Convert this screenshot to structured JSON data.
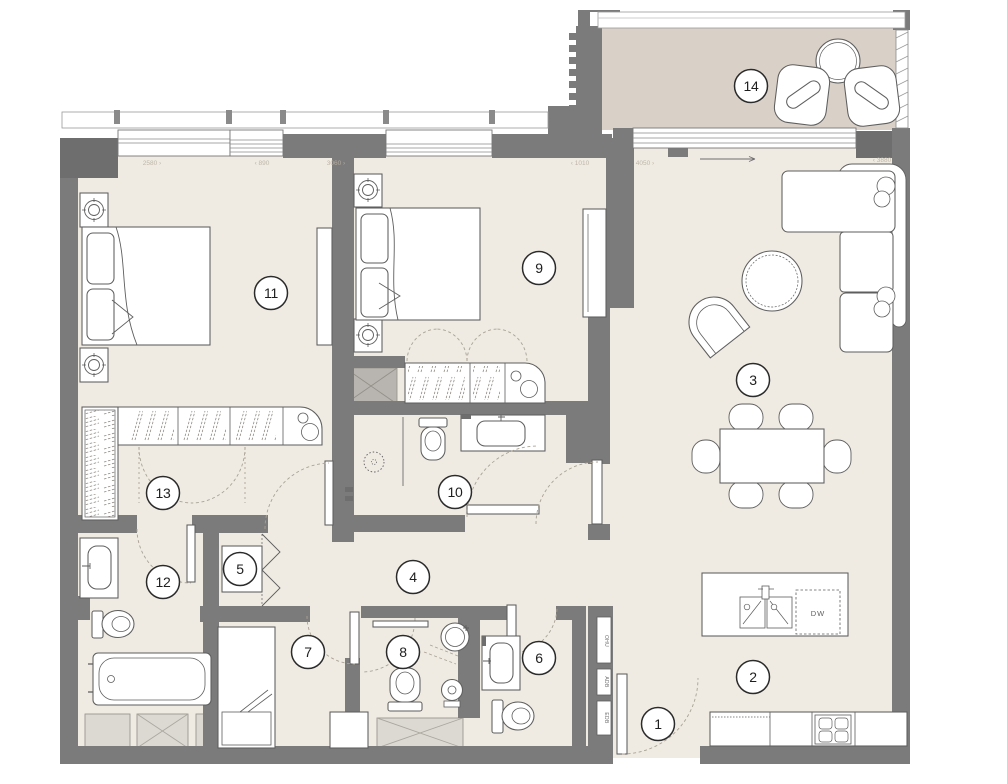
{
  "plan_title": "Apartment floor plan",
  "colors": {
    "wall": "#7b7b7b",
    "wall_dark": "#6e6e6e",
    "floor": "#efebe3",
    "balcony_floor": "#d9d0c8",
    "furniture_line": "#5e5e5e",
    "dash_line": "#a9a295",
    "shaft_fill": "#dcd9d3",
    "duct_fill": "#b8b5b0",
    "dim_text": "#b9b0a2"
  },
  "rooms": [
    {
      "label": "1",
      "x": 658,
      "y": 724
    },
    {
      "label": "2",
      "x": 753,
      "y": 677
    },
    {
      "label": "3",
      "x": 753,
      "y": 380
    },
    {
      "label": "4",
      "x": 413,
      "y": 577
    },
    {
      "label": "5",
      "x": 240,
      "y": 569
    },
    {
      "label": "6",
      "x": 539,
      "y": 658
    },
    {
      "label": "7",
      "x": 308,
      "y": 652
    },
    {
      "label": "8",
      "x": 403,
      "y": 652
    },
    {
      "label": "9",
      "x": 539,
      "y": 268
    },
    {
      "label": "10",
      "x": 455,
      "y": 492
    },
    {
      "label": "11",
      "x": 271,
      "y": 293
    },
    {
      "label": "12",
      "x": 163,
      "y": 582
    },
    {
      "label": "13",
      "x": 163,
      "y": 493
    },
    {
      "label": "14",
      "x": 751,
      "y": 86
    }
  ],
  "dimension_labels": [
    {
      "text": "2580 ›",
      "x": 152,
      "y": 165
    },
    {
      "text": "‹ 890",
      "x": 262,
      "y": 165
    },
    {
      "text": "3060 ›",
      "x": 336,
      "y": 165
    },
    {
      "text": "‹ 1010",
      "x": 580,
      "y": 165
    },
    {
      "text": "4050 ›",
      "x": 645,
      "y": 165
    },
    {
      "text": "‹ 3880",
      "x": 882,
      "y": 162
    }
  ],
  "utility_labels": [
    {
      "text": "OHU",
      "x": 605,
      "y": 641
    },
    {
      "text": "ADB",
      "x": 605,
      "y": 682
    },
    {
      "text": "EDB",
      "x": 605,
      "y": 718
    }
  ],
  "kitchen": {
    "dishwasher_label": "DW"
  }
}
